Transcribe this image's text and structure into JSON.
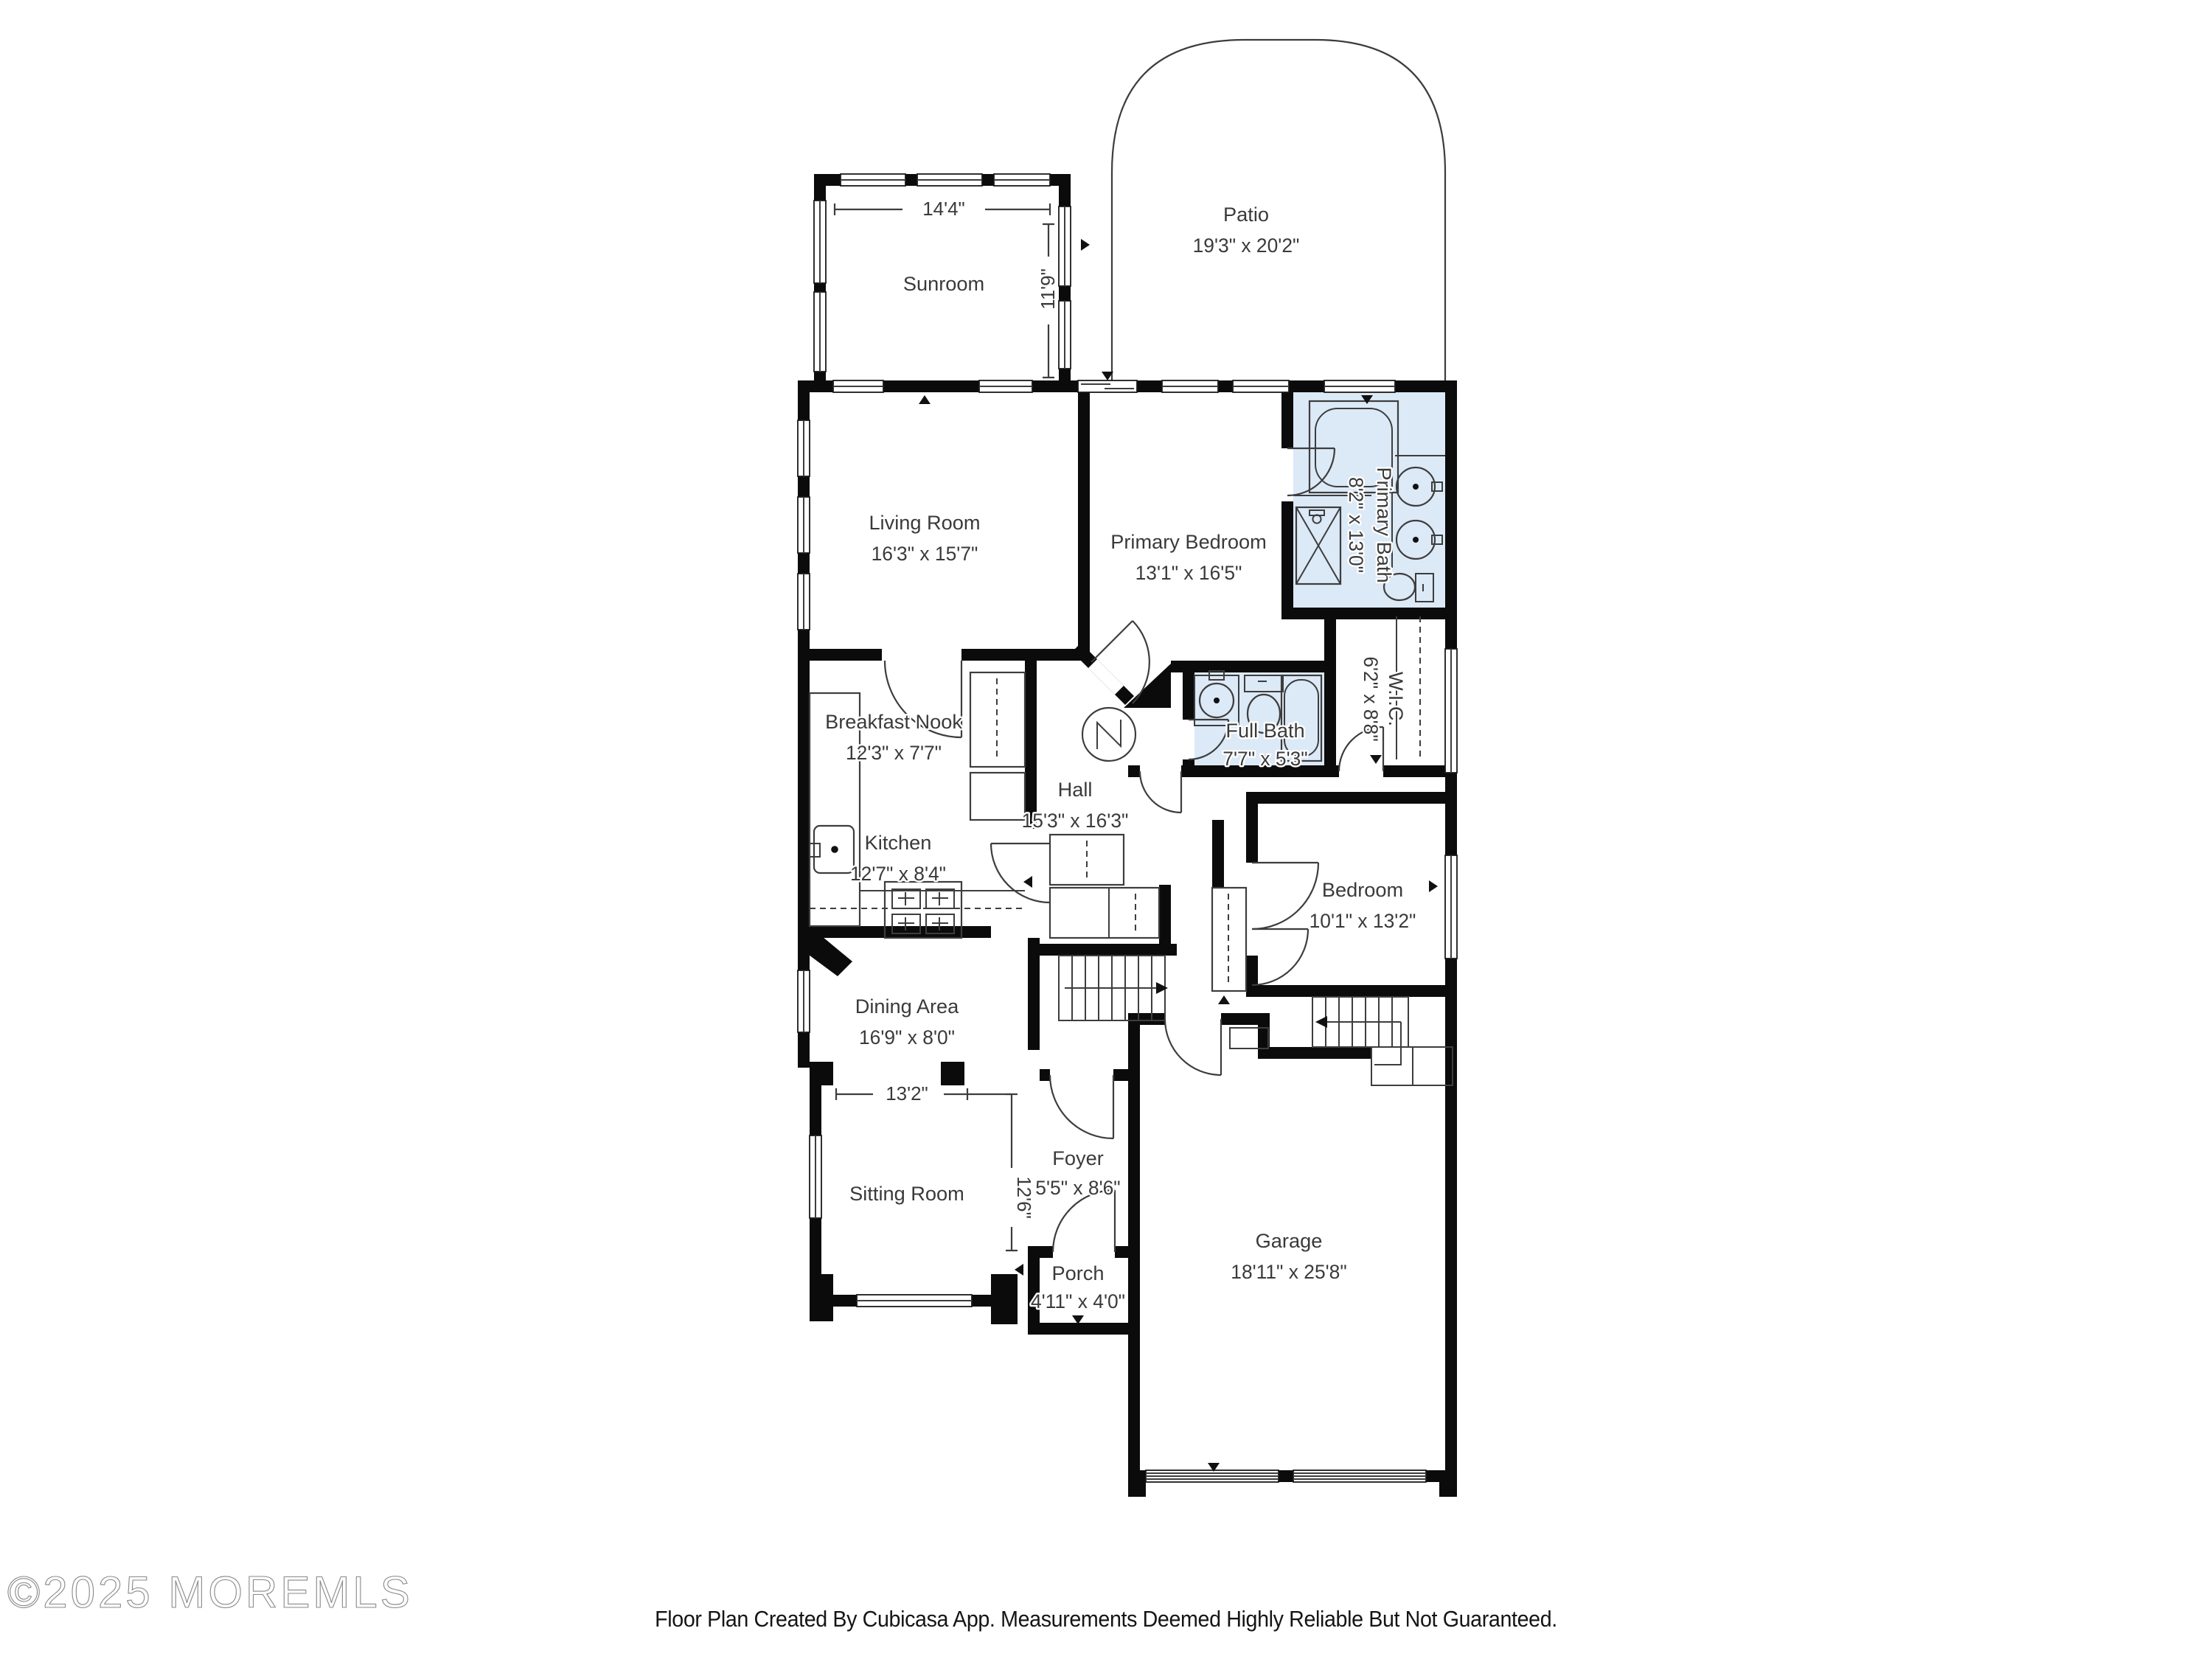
{
  "page": {
    "background": "#ffffff"
  },
  "plan": {
    "rooms": {
      "sunroom": {
        "name": "Sunroom",
        "dims": ""
      },
      "patio": {
        "name": "Patio",
        "dims": "19'3\" x 20'2\""
      },
      "living_room": {
        "name": "Living Room",
        "dims": "16'3\" x 15'7\""
      },
      "primary_bedroom": {
        "name": "Primary Bedroom",
        "dims": "13'1\" x 16'5\""
      },
      "primary_bath": {
        "name": "Primary Bath",
        "dims": "8'2\" x 13'0\""
      },
      "wic": {
        "name": "W.I.C.",
        "dims": "6'2\" x 8'8\""
      },
      "full_bath": {
        "name": "Full Bath",
        "dims": "7'7\" x 5'3\""
      },
      "hall": {
        "name": "Hall",
        "dims": "15'3\" x 16'3\""
      },
      "breakfast_nook": {
        "name": "Breakfast Nook",
        "dims": "12'3\" x 7'7\""
      },
      "kitchen": {
        "name": "Kitchen",
        "dims": "12'7\" x 8'4\""
      },
      "bedroom": {
        "name": "Bedroom",
        "dims": "10'1\" x 13'2\""
      },
      "dining_area": {
        "name": "Dining Area",
        "dims": "16'9\" x 8'0\""
      },
      "sitting_room": {
        "name": "Sitting Room",
        "dims": ""
      },
      "foyer": {
        "name": "Foyer",
        "dims": "5'5\" x 8'6\""
      },
      "porch": {
        "name": "Porch",
        "dims": "4'11\" x 4'0\""
      },
      "garage": {
        "name": "Garage",
        "dims": "18'11\" x 25'8\""
      }
    },
    "dimension_marks": {
      "sunroom_width": "14'4\"",
      "sunroom_depth": "11'9\"",
      "sitting_room_width": "13'2\"",
      "foyer_depth": "12'6\""
    },
    "fixture_icons": [
      "bathtub-icon",
      "shower-icon",
      "toilet-icon",
      "sink-icon",
      "stove-icon",
      "kitchen-sink-icon",
      "staircase-icon",
      "water-heater-icon",
      "closet-rod-icon",
      "garage-door-icon",
      "window-icon",
      "door-swing-icon"
    ]
  },
  "footer": {
    "disclaimer": "Floor Plan Created By Cubicasa App. Measurements Deemed Highly Reliable But Not Guaranteed."
  },
  "watermark": {
    "text": "©2025 MOREMLS"
  },
  "colors": {
    "wall": "#0b0b0b",
    "bath_fill": "#dce9f7",
    "thin_line": "#3d3d3d",
    "label_text": "#3a3a3a",
    "watermark_stroke": "#8a8a8a",
    "footer_text": "#151515"
  }
}
